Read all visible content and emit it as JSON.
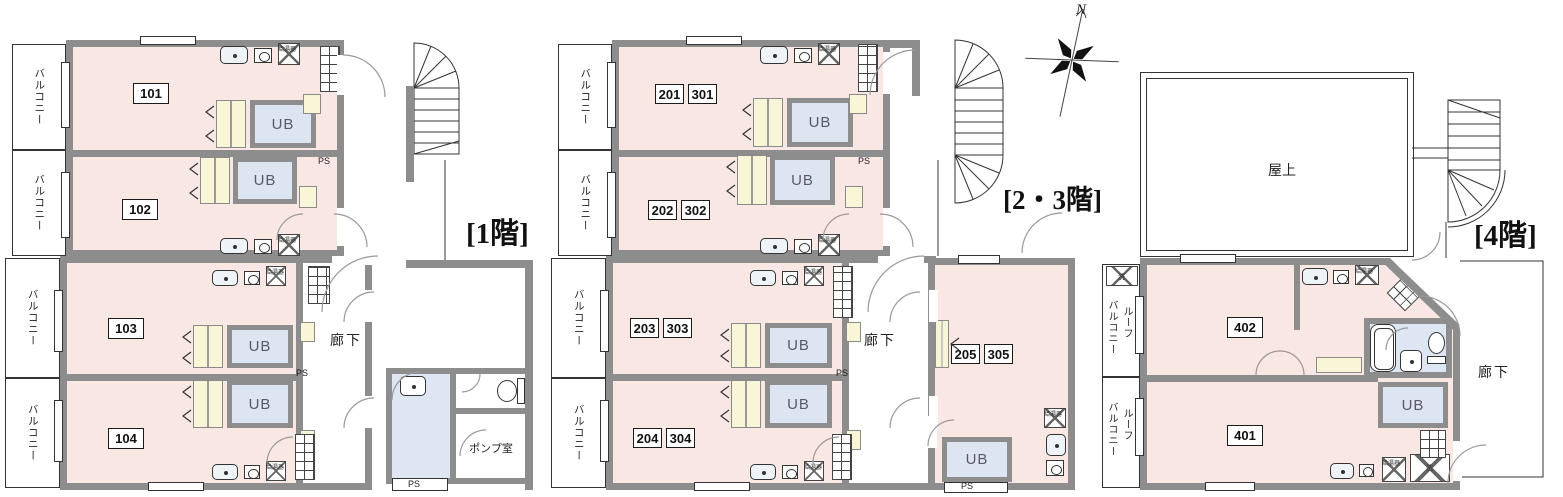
{
  "compass": {
    "north": "N"
  },
  "labels": {
    "balcony": "バルコニー",
    "roof": "ルーフ",
    "unit_bath": "UB",
    "pipe_space": "PS",
    "corridor": "廊下",
    "water_heater": "給湯器",
    "laundry": "洗",
    "pump_room": "ポンプ室",
    "rooftop": "屋上"
  },
  "floor1": {
    "title": "[1階]",
    "units": [
      "101",
      "102",
      "103",
      "104"
    ]
  },
  "floor23": {
    "title": "[2・3階]",
    "unit_pairs": [
      [
        "201",
        "301"
      ],
      [
        "202",
        "302"
      ],
      [
        "203",
        "303"
      ],
      [
        "204",
        "304"
      ],
      [
        "205",
        "305"
      ]
    ]
  },
  "floor4": {
    "title": "[4階]",
    "units": [
      "402",
      "401"
    ]
  }
}
